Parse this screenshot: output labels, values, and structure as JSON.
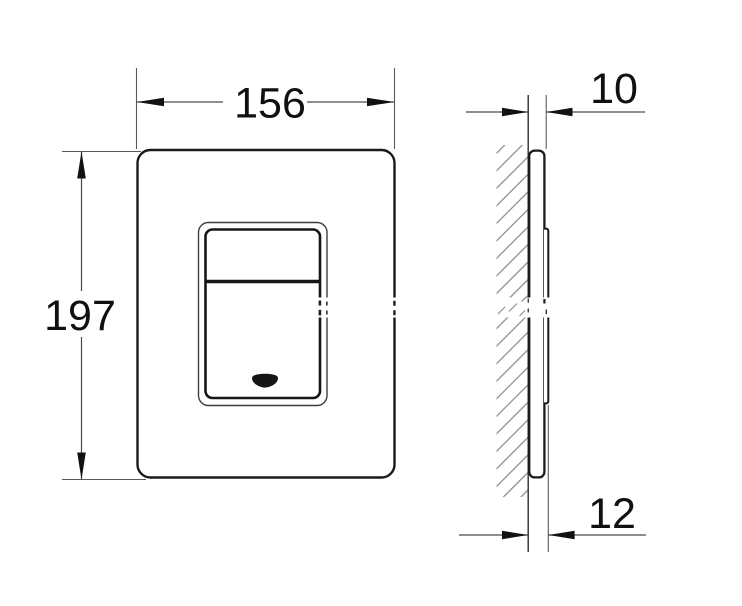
{
  "drawing": {
    "kind": "flush-plate-technical-drawing",
    "dimensions": {
      "front_width": "156",
      "front_height": "197",
      "side_thickness": "10",
      "side_total_depth": "12"
    },
    "colors": {
      "background": "#ffffff",
      "outline": "#1a1a1a",
      "dimension_lines": "#4a4a4a",
      "hatching": "#8c8c8c",
      "text": "#101010"
    }
  }
}
